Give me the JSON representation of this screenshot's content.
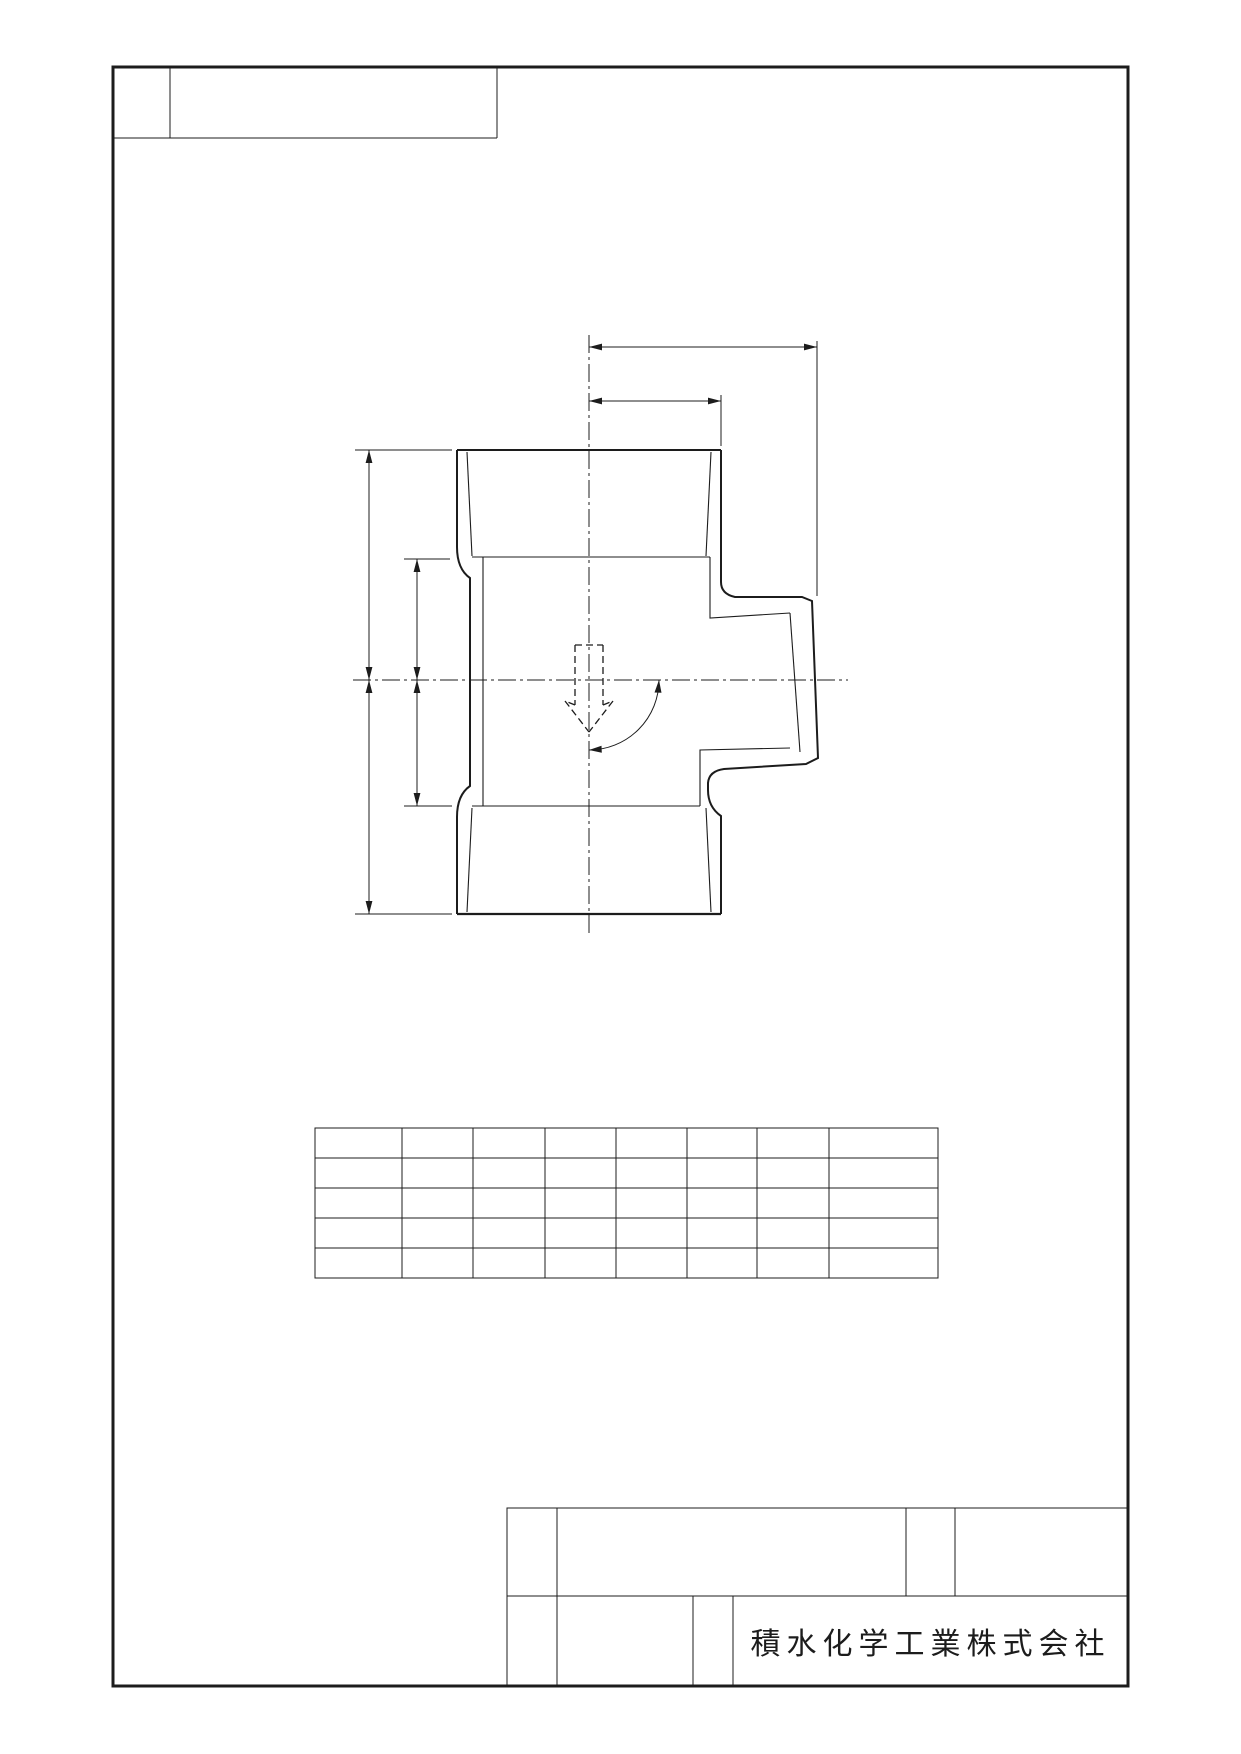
{
  "sheet": {
    "background_color": "#ffffff",
    "line_color": "#1c1c1c"
  },
  "title_block": {
    "company": "積水化学工業株式会社",
    "cells_empty": true
  },
  "revision_box": {
    "cells_empty": true
  },
  "spec_table": {
    "rows": 5,
    "columns": 8,
    "cells_empty": true
  },
  "drawing_view": {
    "description_elements": [
      "tee-fitting-profile",
      "vertical-centerline",
      "horizontal-centerline",
      "flow-direction-arrow",
      "angle-arc-dimension",
      "horizontal-dimension-long",
      "horizontal-dimension-short",
      "vertical-dimension-outer",
      "vertical-dimension-inner"
    ]
  }
}
